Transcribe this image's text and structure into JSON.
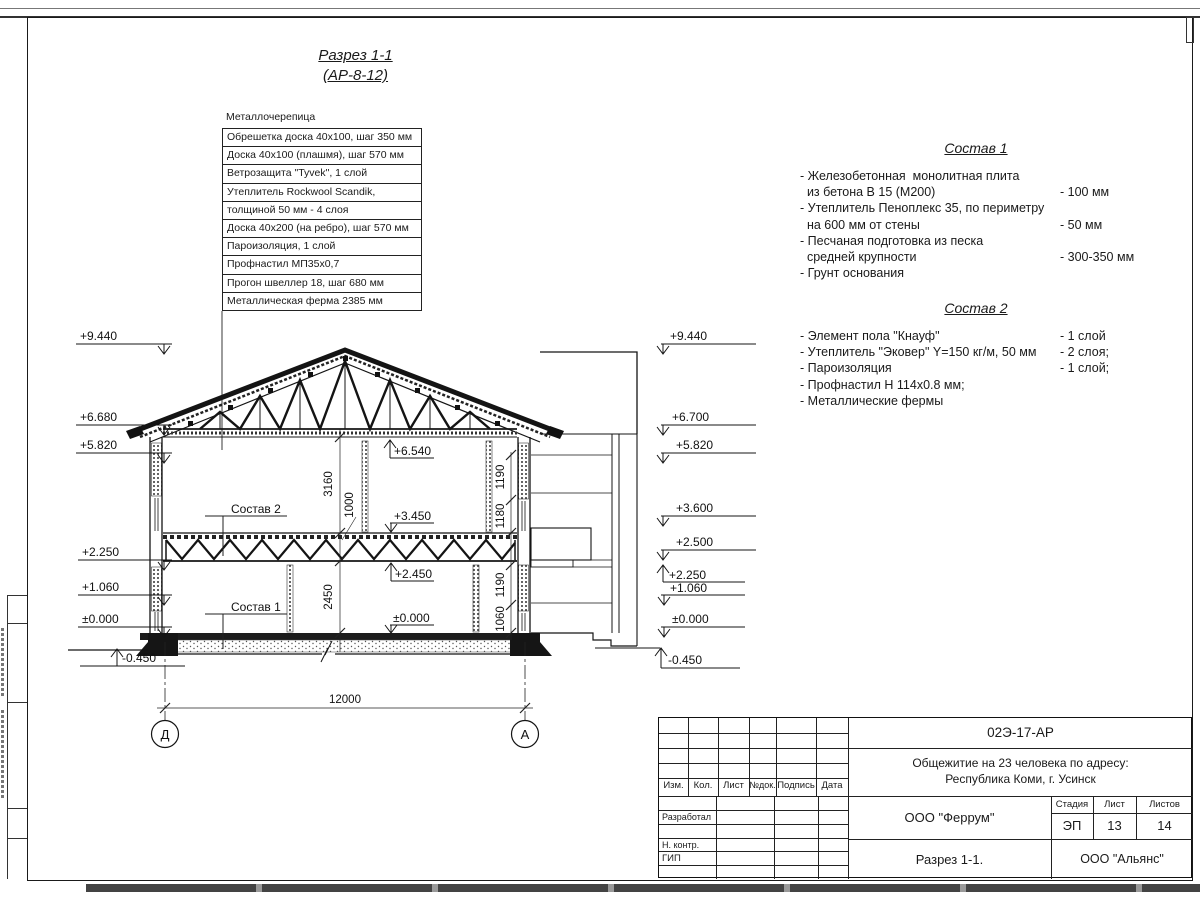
{
  "title": {
    "line1": "Разрез 1-1",
    "line2": "(АР-8-12)"
  },
  "roof_callout": {
    "top_label": "Металлочерепица",
    "rows": [
      "Обрешетка доска 40х100, шаг 350 мм",
      "Доска 40х100 (плашмя), шаг 570 мм",
      "Ветрозащита \"Tyvek\", 1 слой",
      "Утеплитель Rockwool Scandik,",
      "толщиной 50 мм - 4 слоя",
      "Доска 40х200 (на ребро), шаг 570 мм",
      "Пароизоляция, 1 слой",
      "Профнастил МП35х0,7",
      "Прогон швеллер 18, шаг 680 мм",
      "Металлическая ферма 2385 мм"
    ]
  },
  "sostav1": {
    "heading": "Состав 1",
    "rows": [
      {
        "t": "- Железобетонная  монолитная плита",
        "v": ""
      },
      {
        "t": "  из бетона В 15 (М200)",
        "v": "- 100 мм"
      },
      {
        "t": "- Утеплитель Пеноплекс 35, по периметру",
        "v": ""
      },
      {
        "t": "  на 600 мм от стены",
        "v": "- 50 мм"
      },
      {
        "t": "- Песчаная подготовка из песка",
        "v": ""
      },
      {
        "t": "  средней крупности",
        "v": "- 300-350 мм"
      },
      {
        "t": "- Грунт основания",
        "v": ""
      }
    ]
  },
  "sostav2": {
    "heading": "Состав 2",
    "rows": [
      {
        "t": "- Элемент пола \"Кнауф\"",
        "v": "- 1 слой"
      },
      {
        "t": "- Утеплитель \"Эковер\" Y=150 кг/м, 50 мм",
        "v": "- 2 слоя;"
      },
      {
        "t": "- Пароизоляция",
        "v": "- 1 слой;"
      },
      {
        "t": "- Профнастил Н 114х0.8 мм;",
        "v": ""
      },
      {
        "t": "- Металлические фермы",
        "v": ""
      }
    ]
  },
  "marks_left": [
    "+9.440",
    "+6.680",
    "+5.820",
    "+2.250",
    "+1.060",
    "±0.000",
    "-0.450"
  ],
  "marks_right": [
    "+9.440",
    "+6.700",
    "+5.820",
    "+3.600",
    "+2.500",
    "+2.250",
    "+1.060",
    "±0.000",
    "-0.450"
  ],
  "inner_marks": {
    "c6540": "+6.540",
    "c3450": "+3.450",
    "c2450": "+2.450",
    "c0000": "±0.000"
  },
  "dims": {
    "floor2_height": "3160",
    "floor_band": "1000",
    "w2_upper": "1190",
    "w2_lower": "1180",
    "w1_upper": "1190",
    "w1_lower": "1060",
    "floor1_height": "2450",
    "total_width": "12000"
  },
  "section_labels": {
    "sostav2_ref": "Состав 2",
    "sostav1_ref": "Состав 1"
  },
  "axes": {
    "left": "Д",
    "right": "А"
  },
  "titleblock": {
    "doc_number": "02Э-17-АР",
    "project_line1": "Общежитие на 23 человека по адресу:",
    "project_line2": "Республика Коми, г. Усинск",
    "header_cols": [
      "Изм.",
      "Кол.",
      "Лист",
      "№док.",
      "Подпись",
      "Дата"
    ],
    "row_labels": [
      "Разработал",
      "Н. контр.",
      "ГИП"
    ],
    "designer_org": "ООО \"Феррум\"",
    "stage_label": "Стадия",
    "sheet_label": "Лист",
    "sheets_label": "Листов",
    "stage": "ЭП",
    "sheet": "13",
    "sheets": "14",
    "drawing_name": "Разрез 1-1.",
    "contractor_org": "ООО \"Альянс\""
  }
}
